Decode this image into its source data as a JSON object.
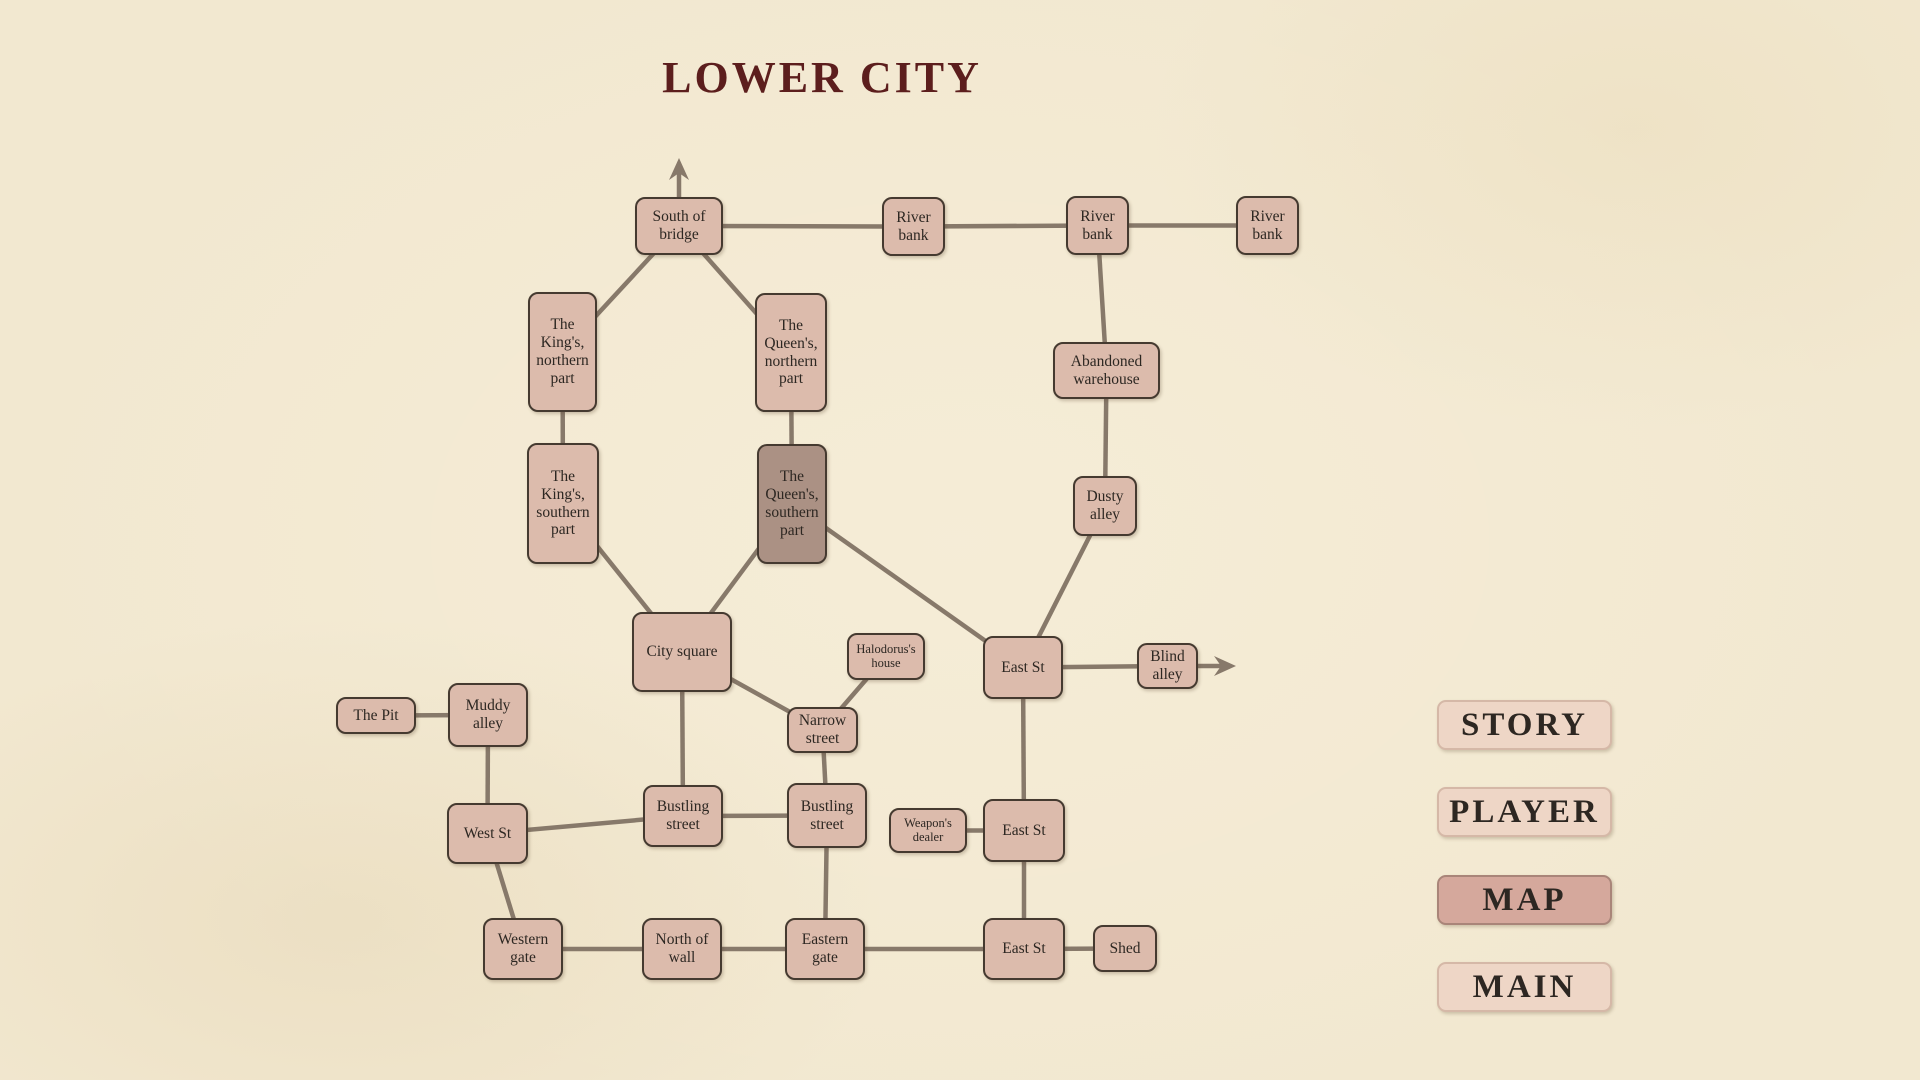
{
  "title": "LOWER CITY",
  "colors": {
    "background": "#f2e8d0",
    "node_fill": "#dcbbac",
    "node_highlight_fill": "#ab9184",
    "node_border": "#453a30",
    "edge": "#87796a",
    "title_text": "#5c1e1d",
    "button_fill": "#eed6c6",
    "button_active_fill": "#d5a89c",
    "button_text": "#2d2722"
  },
  "nav": {
    "buttons": [
      {
        "id": "story",
        "label": "STORY",
        "active": false
      },
      {
        "id": "player",
        "label": "PLAYER",
        "active": false
      },
      {
        "id": "map",
        "label": "MAP",
        "active": true
      },
      {
        "id": "main",
        "label": "MAIN",
        "active": false
      }
    ]
  },
  "map": {
    "current_location": "queens-southern",
    "nodes": [
      {
        "id": "south-of-bridge",
        "label": "South of bridge",
        "x": 635,
        "y": 197,
        "w": 88,
        "h": 58
      },
      {
        "id": "river-bank-1",
        "label": "River bank",
        "x": 882,
        "y": 197,
        "w": 63,
        "h": 59
      },
      {
        "id": "river-bank-2",
        "label": "River bank",
        "x": 1066,
        "y": 196,
        "w": 63,
        "h": 59
      },
      {
        "id": "river-bank-3",
        "label": "River bank",
        "x": 1236,
        "y": 196,
        "w": 63,
        "h": 59
      },
      {
        "id": "kings-northern",
        "label": "The King's, northern part",
        "x": 528,
        "y": 292,
        "w": 69,
        "h": 120
      },
      {
        "id": "queens-northern",
        "label": "The Queen's, northern part",
        "x": 755,
        "y": 293,
        "w": 72,
        "h": 119
      },
      {
        "id": "kings-southern",
        "label": "The King's, southern part",
        "x": 527,
        "y": 443,
        "w": 72,
        "h": 121
      },
      {
        "id": "queens-southern",
        "label": "The Queen's, southern part",
        "x": 757,
        "y": 444,
        "w": 70,
        "h": 120,
        "highlighted": true
      },
      {
        "id": "abandoned-warehouse",
        "label": "Abandoned warehouse",
        "x": 1053,
        "y": 342,
        "w": 107,
        "h": 57
      },
      {
        "id": "dusty-alley",
        "label": "Dusty alley",
        "x": 1073,
        "y": 476,
        "w": 64,
        "h": 60
      },
      {
        "id": "city-square",
        "label": "City square",
        "x": 632,
        "y": 612,
        "w": 100,
        "h": 80
      },
      {
        "id": "halodorus-house",
        "label": "Halodorus's house",
        "x": 847,
        "y": 633,
        "w": 78,
        "h": 47,
        "small": true
      },
      {
        "id": "narrow-street",
        "label": "Narrow street",
        "x": 787,
        "y": 707,
        "w": 71,
        "h": 46
      },
      {
        "id": "east-st-north",
        "label": "East St",
        "x": 983,
        "y": 636,
        "w": 80,
        "h": 63
      },
      {
        "id": "blind-alley",
        "label": "Blind alley",
        "x": 1137,
        "y": 643,
        "w": 61,
        "h": 46
      },
      {
        "id": "the-pit",
        "label": "The Pit",
        "x": 336,
        "y": 697,
        "w": 80,
        "h": 37
      },
      {
        "id": "muddy-alley",
        "label": "Muddy alley",
        "x": 448,
        "y": 683,
        "w": 80,
        "h": 64
      },
      {
        "id": "west-st",
        "label": "West St",
        "x": 447,
        "y": 803,
        "w": 81,
        "h": 61
      },
      {
        "id": "bustling-street-west",
        "label": "Bustling street",
        "x": 643,
        "y": 785,
        "w": 80,
        "h": 62
      },
      {
        "id": "bustling-street-east",
        "label": "Bustling street",
        "x": 787,
        "y": 783,
        "w": 80,
        "h": 65
      },
      {
        "id": "weapons-dealer",
        "label": "Weapon's dealer",
        "x": 889,
        "y": 808,
        "w": 78,
        "h": 45,
        "small": true
      },
      {
        "id": "east-st-mid",
        "label": "East St",
        "x": 983,
        "y": 799,
        "w": 82,
        "h": 63
      },
      {
        "id": "western-gate",
        "label": "Western gate",
        "x": 483,
        "y": 918,
        "w": 80,
        "h": 62
      },
      {
        "id": "north-of-wall",
        "label": "North of wall",
        "x": 642,
        "y": 918,
        "w": 80,
        "h": 62
      },
      {
        "id": "eastern-gate",
        "label": "Eastern gate",
        "x": 785,
        "y": 918,
        "w": 80,
        "h": 62
      },
      {
        "id": "east-st-south",
        "label": "East St",
        "x": 983,
        "y": 918,
        "w": 82,
        "h": 62
      },
      {
        "id": "shed",
        "label": "Shed",
        "x": 1093,
        "y": 925,
        "w": 64,
        "h": 47
      }
    ],
    "edges": [
      [
        "south-of-bridge",
        "river-bank-1"
      ],
      [
        "river-bank-1",
        "river-bank-2"
      ],
      [
        "river-bank-2",
        "river-bank-3"
      ],
      [
        "river-bank-2",
        "abandoned-warehouse"
      ],
      [
        "abandoned-warehouse",
        "dusty-alley"
      ],
      [
        "dusty-alley",
        "east-st-north"
      ],
      [
        "south-of-bridge",
        "kings-northern"
      ],
      [
        "south-of-bridge",
        "queens-northern"
      ],
      [
        "kings-northern",
        "kings-southern"
      ],
      [
        "queens-northern",
        "queens-southern"
      ],
      [
        "kings-southern",
        "city-square"
      ],
      [
        "queens-southern",
        "city-square"
      ],
      [
        "queens-southern",
        "east-st-north"
      ],
      [
        "city-square",
        "narrow-street"
      ],
      [
        "halodorus-house",
        "narrow-street"
      ],
      [
        "city-square",
        "bustling-street-west"
      ],
      [
        "narrow-street",
        "bustling-street-east"
      ],
      [
        "east-st-north",
        "blind-alley"
      ],
      [
        "east-st-north",
        "east-st-mid"
      ],
      [
        "weapons-dealer",
        "east-st-mid"
      ],
      [
        "east-st-mid",
        "east-st-south"
      ],
      [
        "the-pit",
        "muddy-alley"
      ],
      [
        "muddy-alley",
        "west-st"
      ],
      [
        "west-st",
        "bustling-street-west"
      ],
      [
        "west-st",
        "western-gate"
      ],
      [
        "bustling-street-west",
        "bustling-street-east"
      ],
      [
        "bustling-street-east",
        "eastern-gate"
      ],
      [
        "western-gate",
        "north-of-wall"
      ],
      [
        "north-of-wall",
        "eastern-gate"
      ],
      [
        "eastern-gate",
        "east-st-south"
      ],
      [
        "east-st-south",
        "shed"
      ]
    ],
    "exit_arrows": [
      {
        "id": "north-exit-arrow",
        "x1": 679,
        "y1": 198,
        "x2": 679,
        "y2": 166,
        "dir": "up"
      },
      {
        "id": "east-exit-arrow",
        "x1": 1197,
        "y1": 666,
        "x2": 1226,
        "y2": 666,
        "dir": "right"
      }
    ]
  }
}
